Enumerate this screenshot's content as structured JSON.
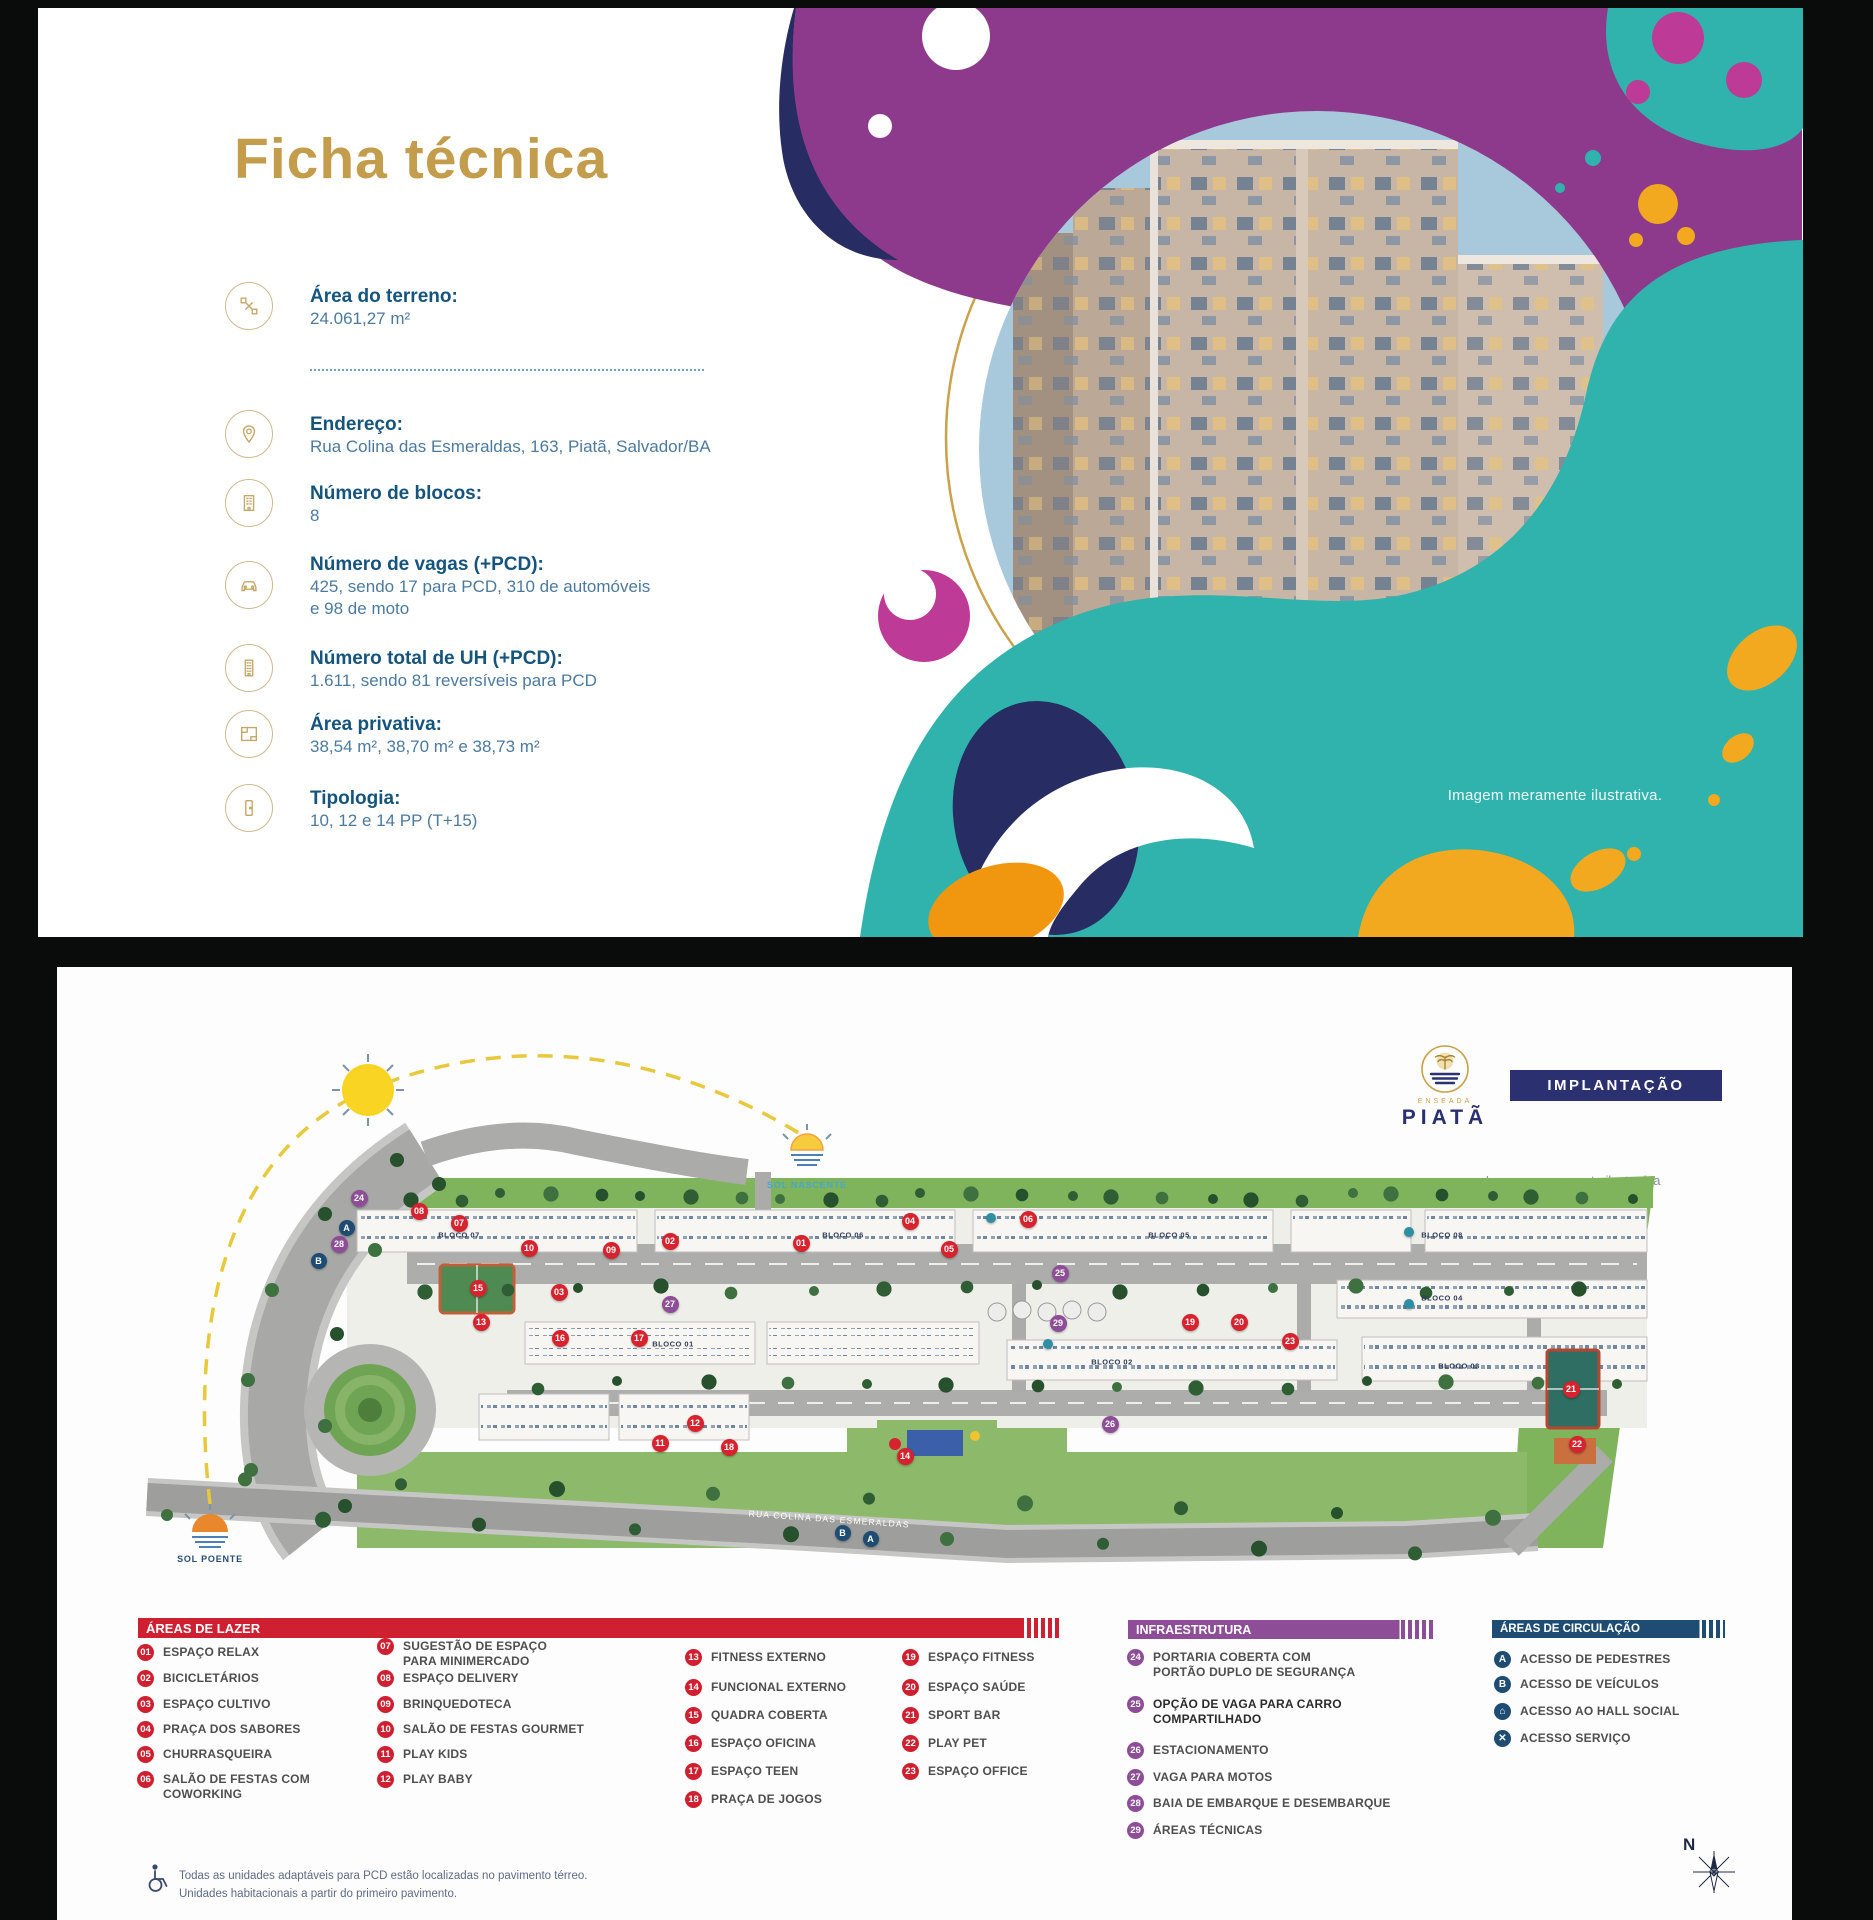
{
  "top_panel": {
    "title": "Ficha técnica",
    "image_note": "Imagem meramente ilustrativa.",
    "specs": [
      {
        "icon": "area-icon",
        "label": "Área do terreno:",
        "lines": [
          "24.061,27 m²"
        ]
      },
      {
        "icon": "map-pin-icon",
        "label": "Endereço:",
        "lines": [
          "Rua Colina das Esmeraldas, 163, Piatã, Salvador/BA"
        ]
      },
      {
        "icon": "building-icon",
        "label": "Número de blocos:",
        "lines": [
          "8"
        ]
      },
      {
        "icon": "car-icon",
        "label": "Número de vagas (+PCD):",
        "lines": [
          "425, sendo 17 para PCD, 310 de automóveis",
          "e 98 de moto"
        ]
      },
      {
        "icon": "tower-icon",
        "label": "Número total de UH (+PCD):",
        "lines": [
          "1.611, sendo 81 reversíveis para PCD"
        ]
      },
      {
        "icon": "floorplan-icon",
        "label": "Área privativa:",
        "lines": [
          "38,54 m², 38,70 m² e 38,73 m²"
        ]
      },
      {
        "icon": "door-icon",
        "label": "Tipologia:",
        "lines": [
          "10, 12 e 14 PP (T+15)"
        ]
      }
    ],
    "colors": {
      "title_gold": "#C49D4C",
      "heading_blue": "#15547D",
      "body_blue": "#4C7A9E",
      "teal": "#2FB3AC",
      "purple": "#8E3A8C",
      "navy": "#272C63",
      "yellow": "#F2A81F",
      "magenta": "#BE3A97"
    }
  },
  "bottom_panel": {
    "logo": {
      "brand_small": "ENSEADA",
      "brand": "PIATÃ"
    },
    "button_label": "IMPLANTAÇÃO",
    "image_note": "Imagem meramente ilustrativa",
    "compass_label": "N",
    "footer_note": [
      "Todas as unidades adaptáveis para PCD estão localizadas no pavimento térreo.",
      "Unidades habitacionais a partir do primeiro pavimento."
    ],
    "siteplan": {
      "sun_east_label": "SOL NASCENTE",
      "sun_west_label": "SOL POENTE",
      "street_label": "RUA COLINA DAS ESMERALDAS",
      "blocos": [
        {
          "label": "BLOCO 07",
          "x": 352,
          "y": 243
        },
        {
          "label": "BLOCO 06",
          "x": 736,
          "y": 243
        },
        {
          "label": "BLOCO 05",
          "x": 1062,
          "y": 243
        },
        {
          "label": "BLOCO 08",
          "x": 1335,
          "y": 243
        },
        {
          "label": "BLOCO 04",
          "x": 1335,
          "y": 306
        },
        {
          "label": "BLOCO 01",
          "x": 566,
          "y": 352
        },
        {
          "label": "BLOCO 02",
          "x": 1005,
          "y": 370
        },
        {
          "label": "BLOCO 03",
          "x": 1352,
          "y": 374
        }
      ],
      "markers": [
        {
          "c": "r",
          "n": "01",
          "x": 694,
          "y": 251
        },
        {
          "c": "r",
          "n": "02",
          "x": 563,
          "y": 249
        },
        {
          "c": "r",
          "n": "03",
          "x": 452,
          "y": 300
        },
        {
          "c": "r",
          "n": "04",
          "x": 803,
          "y": 229
        },
        {
          "c": "r",
          "n": "05",
          "x": 842,
          "y": 257
        },
        {
          "c": "r",
          "n": "06",
          "x": 921,
          "y": 227
        },
        {
          "c": "r",
          "n": "07",
          "x": 352,
          "y": 231
        },
        {
          "c": "r",
          "n": "08",
          "x": 312,
          "y": 219
        },
        {
          "c": "r",
          "n": "09",
          "x": 504,
          "y": 258
        },
        {
          "c": "r",
          "n": "10",
          "x": 422,
          "y": 256
        },
        {
          "c": "r",
          "n": "11",
          "x": 553,
          "y": 451
        },
        {
          "c": "r",
          "n": "12",
          "x": 588,
          "y": 431
        },
        {
          "c": "r",
          "n": "13",
          "x": 374,
          "y": 330
        },
        {
          "c": "r",
          "n": "14",
          "x": 798,
          "y": 464
        },
        {
          "c": "r",
          "n": "15",
          "x": 371,
          "y": 296
        },
        {
          "c": "r",
          "n": "16",
          "x": 453,
          "y": 346
        },
        {
          "c": "r",
          "n": "17",
          "x": 532,
          "y": 346
        },
        {
          "c": "r",
          "n": "18",
          "x": 622,
          "y": 455
        },
        {
          "c": "r",
          "n": "19",
          "x": 1083,
          "y": 330
        },
        {
          "c": "r",
          "n": "20",
          "x": 1132,
          "y": 330
        },
        {
          "c": "r",
          "n": "21",
          "x": 1464,
          "y": 397
        },
        {
          "c": "r",
          "n": "22",
          "x": 1470,
          "y": 452
        },
        {
          "c": "r",
          "n": "23",
          "x": 1183,
          "y": 349
        },
        {
          "c": "p",
          "n": "24",
          "x": 252,
          "y": 206
        },
        {
          "c": "p",
          "n": "25",
          "x": 953,
          "y": 281
        },
        {
          "c": "p",
          "n": "26",
          "x": 1003,
          "y": 432
        },
        {
          "c": "p",
          "n": "27",
          "x": 563,
          "y": 312
        },
        {
          "c": "p",
          "n": "28",
          "x": 232,
          "y": 252
        },
        {
          "c": "p",
          "n": "29",
          "x": 951,
          "y": 331
        },
        {
          "c": "b",
          "n": "A",
          "x": 240,
          "y": 236
        },
        {
          "c": "b",
          "n": "B",
          "x": 212,
          "y": 269
        },
        {
          "c": "b",
          "n": "B",
          "x": 736,
          "y": 541
        },
        {
          "c": "b",
          "n": "A",
          "x": 764,
          "y": 547
        },
        {
          "c": "t",
          "n": "",
          "x": 884,
          "y": 226
        },
        {
          "c": "t",
          "n": "",
          "x": 941,
          "y": 352
        },
        {
          "c": "t",
          "n": "",
          "x": 1302,
          "y": 240
        },
        {
          "c": "t",
          "n": "",
          "x": 1302,
          "y": 312
        }
      ]
    },
    "legend": {
      "lazer": {
        "title": "ÁREAS DE LAZER",
        "color": "#CE2030",
        "items": [
          {
            "num": "01",
            "label": [
              "ESPAÇO RELAX"
            ]
          },
          {
            "num": "02",
            "label": [
              "BICICLETÁRIOS"
            ]
          },
          {
            "num": "03",
            "label": [
              "ESPAÇO CULTIVO"
            ]
          },
          {
            "num": "04",
            "label": [
              "PRAÇA DOS SABORES"
            ]
          },
          {
            "num": "05",
            "label": [
              "CHURRASQUEIRA"
            ]
          },
          {
            "num": "06",
            "label": [
              "SALÃO DE FESTAS COM",
              "COWORKING"
            ]
          },
          {
            "num": "07",
            "label": [
              "SUGESTÃO DE ESPAÇO",
              "PARA MINIMERCADO"
            ]
          },
          {
            "num": "08",
            "label": [
              "ESPAÇO DELIVERY"
            ]
          },
          {
            "num": "09",
            "label": [
              "BRINQUEDOTECA"
            ]
          },
          {
            "num": "10",
            "label": [
              "SALÃO DE FESTAS GOURMET"
            ]
          },
          {
            "num": "11",
            "label": [
              "PLAY KIDS"
            ]
          },
          {
            "num": "12",
            "label": [
              "PLAY BABY"
            ]
          },
          {
            "num": "13",
            "label": [
              "FITNESS EXTERNO"
            ]
          },
          {
            "num": "14",
            "label": [
              "FUNCIONAL EXTERNO"
            ]
          },
          {
            "num": "15",
            "label": [
              "QUADRA COBERTA"
            ]
          },
          {
            "num": "16",
            "label": [
              "ESPAÇO OFICINA"
            ]
          },
          {
            "num": "17",
            "label": [
              "ESPAÇO TEEN"
            ]
          },
          {
            "num": "18",
            "label": [
              "PRAÇA DE JOGOS"
            ]
          },
          {
            "num": "19",
            "label": [
              "ESPAÇO FITNESS"
            ]
          },
          {
            "num": "20",
            "label": [
              "ESPAÇO SAÚDE"
            ]
          },
          {
            "num": "21",
            "label": [
              "SPORT BAR"
            ]
          },
          {
            "num": "22",
            "label": [
              "PLAY PET"
            ]
          },
          {
            "num": "23",
            "label": [
              "ESPAÇO OFFICE"
            ]
          }
        ]
      },
      "infra": {
        "title": "INFRAESTRUTURA",
        "color": "#8E4E97",
        "items": [
          {
            "num": "24",
            "label": [
              "PORTARIA COBERTA COM",
              "PORTÃO DUPLO DE SEGURANÇA"
            ]
          },
          {
            "num": "25",
            "label": [
              "OPÇÃO DE VAGA PARA CARRO",
              "COMPARTILHADO"
            ],
            "strong": true
          },
          {
            "num": "26",
            "label": [
              "ESTACIONAMENTO"
            ]
          },
          {
            "num": "27",
            "label": [
              "VAGA PARA MOTOS"
            ]
          },
          {
            "num": "28",
            "label": [
              "BAIA DE EMBARQUE E DESEMBARQUE"
            ]
          },
          {
            "num": "29",
            "label": [
              "ÁREAS TÉCNICAS"
            ]
          }
        ]
      },
      "circulacao": {
        "title": "ÁREAS DE CIRCULAÇÃO",
        "color": "#1F4C72",
        "items": [
          {
            "glyph": "A",
            "icon": "pedestrian-access-icon",
            "label": [
              "ACESSO DE PEDESTRES"
            ]
          },
          {
            "glyph": "B",
            "icon": "vehicle-access-icon",
            "label": [
              "ACESSO DE VEÍCULOS"
            ]
          },
          {
            "glyph": "⌂",
            "icon": "hall-access-icon",
            "label": [
              "ACESSO AO HALL SOCIAL"
            ]
          },
          {
            "glyph": "✕",
            "icon": "service-access-icon",
            "label": [
              "ACESSO SERVIÇO"
            ]
          }
        ]
      }
    }
  }
}
